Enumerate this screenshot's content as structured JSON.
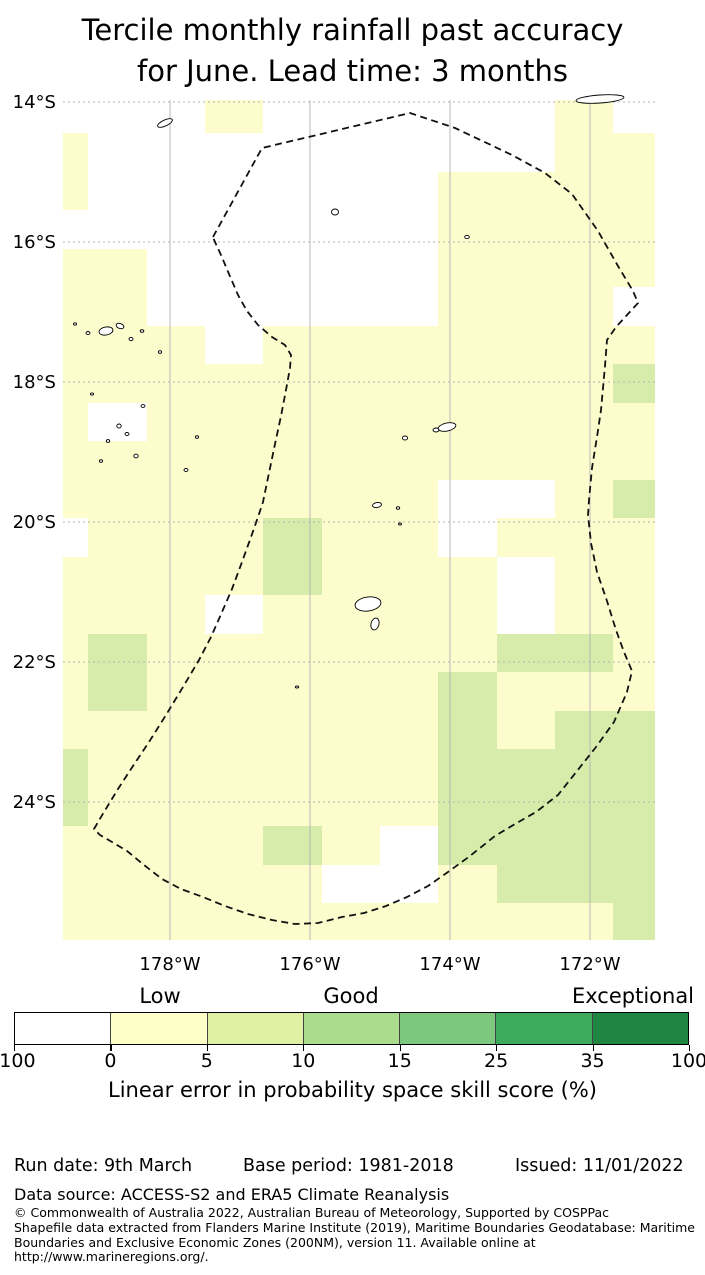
{
  "title": {
    "line1": "Tercile monthly rainfall past accuracy",
    "line2": "for June. Lead time: 3 months"
  },
  "colors": {
    "cell_yellow": "#fcfccd",
    "cell_green": "#d7ecaa",
    "grid": "#b3b3b3",
    "eez": "#111111",
    "island_fill": "#ffffff"
  },
  "map": {
    "x_left": 63,
    "x_right": 655,
    "y_top": 100,
    "y_bottom": 940,
    "lat_ticks": [
      {
        "label": "14°S",
        "y": 102
      },
      {
        "label": "16°S",
        "y": 242
      },
      {
        "label": "18°S",
        "y": 382
      },
      {
        "label": "20°S",
        "y": 522
      },
      {
        "label": "22°S",
        "y": 662
      },
      {
        "label": "24°S",
        "y": 802
      }
    ],
    "lon_ticks": [
      {
        "label": "178°W",
        "x": 170
      },
      {
        "label": "176°W",
        "x": 310
      },
      {
        "label": "174°W",
        "x": 450
      },
      {
        "label": "172°W",
        "x": 590
      }
    ],
    "col_edges": [
      63,
      88,
      147,
      205,
      263,
      322,
      380,
      438,
      497,
      555,
      613,
      655
    ],
    "row_edges": [
      100,
      133,
      172,
      210,
      249,
      287,
      326,
      364,
      403,
      441,
      480,
      518,
      557,
      595,
      634,
      672,
      711,
      749,
      788,
      826,
      865,
      903,
      940
    ],
    "cells": [
      "WWWYWWWWWYW",
      "YWWWWWWWWYY",
      "YWWWWWWYYYY",
      "WWWWWWWYYYY",
      "YYWWWWWYYYY",
      "YYWWWWWYYYW",
      "YYYWYYYYYYY",
      "YYYYYYYYYYG",
      "YWYYYYYYYYY",
      "YYYYYYYYYYY",
      "YYYYYYYWWYG",
      "WYYYGYYWYYY",
      "YYYYGYYYWYY",
      "YYYWYYYYWYY",
      "YGYYYYYYGGY",
      "YGYYYYYGYYY",
      "YYYYYYYGYGG",
      "GYYYYYYGGGG",
      "GYYYYYYGGGG",
      "YYYYGYWGGGG",
      "YYYYYWWYGGG",
      "YYYYYYYYYYG"
    ],
    "eez_points": "213,237 262,148 410,113 455,128 512,155 545,173 572,194 598,231 618,266 633,291 638,303 616,327 607,340 605,366 601,410 597,437 592,468 589,500 588,515 591,543 597,572 607,601 616,630 624,652 632,671 627,692 614,722 596,747 577,771 558,795 536,812 515,824 495,836 470,856 448,872 428,886 407,897 386,906 364,913 342,917 318,923 295,924 272,920 248,914 225,906 203,897 181,889 162,879 144,865 127,851 112,842 100,835 94,829 104,812 118,789 133,766 149,742 166,715 183,687 199,660 211,637 222,612 232,589 242,562 251,537 258,517 263,502 269,473 275,444 281,416 286,390 290,368 291,355 285,345 272,337 258,325 247,311 238,295 229,274 221,255 215,242",
    "islands": [
      [
        165,
        123,
        8,
        3,
        -25
      ],
      [
        335,
        212,
        3.5,
        3,
        0
      ],
      [
        467,
        237,
        2.3,
        1.6,
        0
      ],
      [
        600,
        99,
        24,
        4,
        -4
      ],
      [
        106,
        331,
        7,
        4,
        -10
      ],
      [
        120,
        326,
        4,
        2.5,
        20
      ],
      [
        88,
        333,
        2,
        1.5,
        0
      ],
      [
        131,
        339,
        2,
        1.7,
        0
      ],
      [
        75,
        324,
        1.5,
        1.2,
        0
      ],
      [
        142,
        331,
        1.8,
        1.3,
        0
      ],
      [
        160,
        352,
        1.6,
        1.3,
        0
      ],
      [
        92,
        394,
        1.6,
        1.1,
        0
      ],
      [
        143,
        406,
        2,
        1.4,
        0
      ],
      [
        119,
        426,
        2.2,
        2,
        0
      ],
      [
        127,
        434,
        2,
        1.5,
        0
      ],
      [
        108,
        441,
        1.7,
        1.4,
        0
      ],
      [
        136,
        456,
        2.2,
        1.8,
        0
      ],
      [
        101,
        461,
        1.6,
        1.3,
        0
      ],
      [
        186,
        470,
        2,
        1.5,
        0
      ],
      [
        197,
        437,
        1.6,
        1.3,
        0
      ],
      [
        447,
        427,
        9,
        4,
        -12
      ],
      [
        436,
        430,
        3,
        2,
        0
      ],
      [
        405,
        438,
        2.6,
        2,
        0
      ],
      [
        377,
        505,
        4.5,
        2.5,
        -10
      ],
      [
        398,
        508,
        1.7,
        1.3,
        0
      ],
      [
        368,
        604,
        13,
        7,
        -8
      ],
      [
        375,
        624,
        4,
        6,
        15
      ],
      [
        297,
        687,
        1.7,
        1,
        0
      ],
      [
        400,
        524,
        1.5,
        1,
        0
      ]
    ]
  },
  "legend": {
    "labels": [
      {
        "text": "Low",
        "x": 160
      },
      {
        "text": "Good",
        "x": 351
      },
      {
        "text": "Exceptional",
        "x": 633
      }
    ],
    "labels_y": 984,
    "bar": {
      "x": 14,
      "y": 1012,
      "width": 675,
      "height": 33,
      "colors": [
        "#ffffff",
        "#ffffc8",
        "#e1f1a4",
        "#abdc8e",
        "#7cc87e",
        "#3daa5c",
        "#1f8641"
      ],
      "tick_labels": [
        "-100",
        "0",
        "5",
        "10",
        "15",
        "25",
        "35",
        "100"
      ]
    },
    "axis_label": "Linear error in probability space skill score (%)"
  },
  "footer": {
    "run_date": "Run date: 9th March",
    "base_period": "Base period: 1981-2018",
    "issued": "Issued: 11/01/2022",
    "data_source": "Data source: ACCESS-S2 and ERA5 Climate Reanalysis",
    "copyright_lines": [
      "© Commonwealth of Australia 2022, Australian Bureau of Meteorology, Supported by COSPPac",
      "Shapefile data extracted from Flanders Marine Institute (2019), Maritime Boundaries Geodatabase: Maritime",
      "Boundaries and Exclusive Economic Zones (200NM), version 11. Available online at",
      "http://www.marineregions.org/."
    ]
  },
  "chart_data": {
    "type": "heatmap",
    "title": "Tercile monthly rainfall past accuracy for June. Lead time: 3 months",
    "xlabel": "Longitude",
    "ylabel": "Latitude",
    "x_tick_labels": [
      "178°W",
      "176°W",
      "174°W",
      "172°W"
    ],
    "y_tick_labels": [
      "14°S",
      "16°S",
      "18°S",
      "20°S",
      "22°S",
      "24°S"
    ],
    "x_range_deg_west": [
      179.5,
      171.1
    ],
    "y_range_deg_south": [
      14.0,
      26.0
    ],
    "colorbar": {
      "label": "Linear error in probability space skill score (%)",
      "bin_edges": [
        -100,
        0,
        5,
        10,
        15,
        25,
        35,
        100
      ],
      "bin_colors": [
        "#ffffff",
        "#ffffc8",
        "#e1f1a4",
        "#abdc8e",
        "#7cc87e",
        "#3daa5c",
        "#1f8641"
      ],
      "category_labels": [
        "Low",
        "Good",
        "Exceptional"
      ]
    },
    "cell_value_legend": {
      "W": "-100–0 %",
      "Y": "0–5 %",
      "G": "5–10 %"
    },
    "cells_by_row": [
      "WWWYWWWWWYW",
      "YWWWWWWWWYY",
      "YWWWWWWYYYY",
      "WWWWWWWYYYY",
      "YYWWWWWYYYY",
      "YYWWWWWYYYW",
      "YYYWYYYYYYY",
      "YYYYYYYYYYG",
      "YWYYYYYYYYY",
      "YYYYYYYYYYY",
      "YYYYYYYWWYG",
      "WYYYGYYWYYY",
      "YYYYGYYYWYY",
      "YYYWYYYYWYY",
      "YGYYYYYYGGY",
      "YGYYYYYGYYY",
      "YYYYYYYGYGG",
      "GYYYYYYGGGG",
      "GYYYYYYGGGG",
      "YYYYGYWGGGG",
      "YYYYYWWYGGG",
      "YYYYYYYYYYG"
    ],
    "overlay": "Dashed polygon: Exclusive Economic Zone (200NM) boundary; small black outlines: islands (Fiji / Tonga region)",
    "grid": true,
    "legend_position": "bottom"
  }
}
